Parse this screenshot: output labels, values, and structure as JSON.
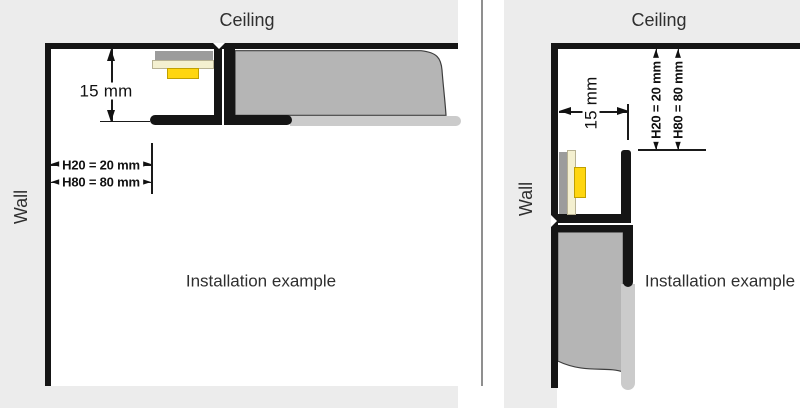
{
  "diagram": {
    "panels": [
      {
        "name": "ceiling-installation",
        "ceiling_label": "Ceiling",
        "wall_label": "Wall",
        "caption": "Installation example",
        "dimensions": {
          "profile_offset": "15 mm",
          "h20": "H20 = 20 mm",
          "h80": "H80 = 80 mm"
        }
      },
      {
        "name": "wall-installation",
        "ceiling_label": "Ceiling",
        "wall_label": "Wall",
        "caption": "Installation example",
        "dimensions": {
          "profile_offset": "15 mm",
          "h20": "H20 = 20 mm",
          "h80": "H80 = 80 mm"
        }
      }
    ],
    "colors": {
      "background": "#ececec",
      "drawing_area": "#ffffff",
      "outline_black": "#151515",
      "board_gray": "#b5b5b5",
      "profile_base_gray": "#9c9c9c",
      "led_carrier_cream": "#f4f0d0",
      "led_yellow": "#ffd60f",
      "shadow_gray": "#cbcbcb",
      "divider_gray": "#8f8f8f"
    }
  }
}
